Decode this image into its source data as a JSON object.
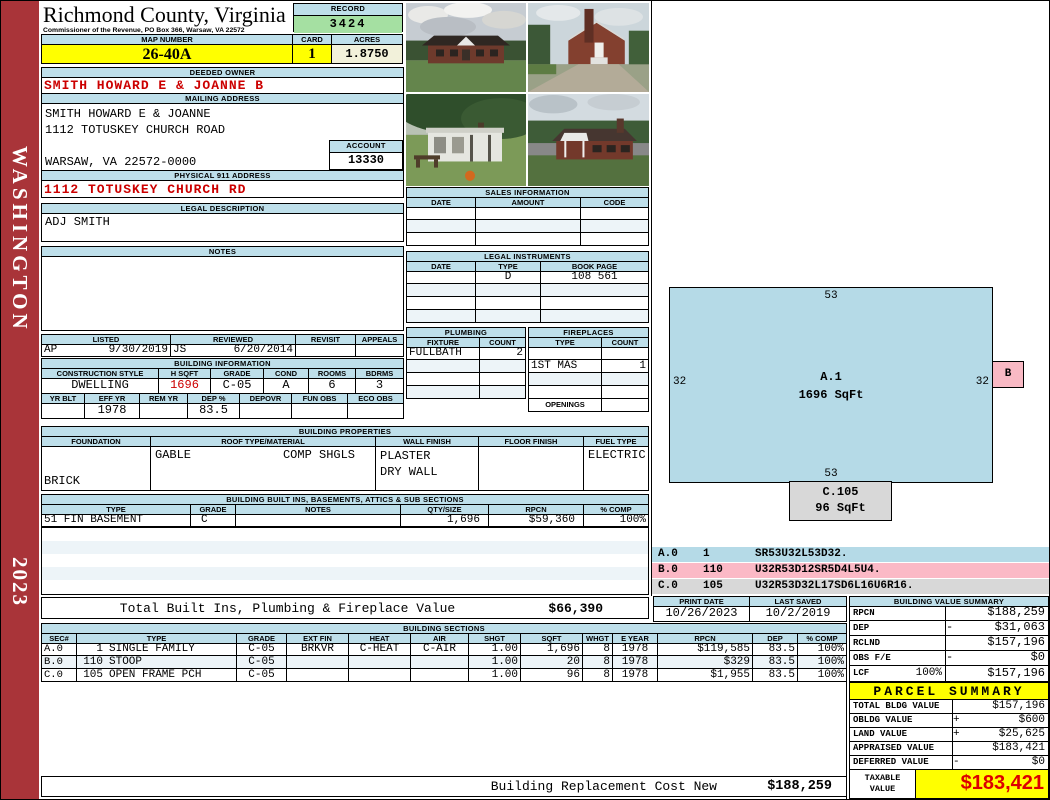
{
  "colors": {
    "bar_blue": "#BEDFEA",
    "yellow": "#FFFF00",
    "record_green": "#A5E0A2",
    "acres_cream": "#F2F1DA",
    "red_text": "#CC0000",
    "sidebar_red": "#A93439",
    "sketch_blue": "#B5DAE7",
    "sketch_pink": "#F9B9C4",
    "sketch_gray": "#D8D8D8"
  },
  "sidebar": {
    "state": "WASHINGTON",
    "year": "2023"
  },
  "header": {
    "county": "Richmond County, Virginia",
    "commissioner_line": "Commissioner of the Revenue, PO Box 366, Warsaw, VA 22572",
    "record_label": "RECORD",
    "record_number": "3424",
    "map_number_label": "MAP NUMBER",
    "map_number": "26-40A",
    "card_label": "CARD",
    "card": "1",
    "acres_label": "ACRES",
    "acres": "1.8750"
  },
  "owner": {
    "deeded_owner_label": "DEEDED OWNER",
    "deeded_owner": "SMITH HOWARD E & JOANNE B",
    "mailing_address_label": "MAILING ADDRESS",
    "mailing_line1": "SMITH HOWARD E & JOANNE",
    "mailing_line2": "1112 TOTUSKEY CHURCH ROAD",
    "mailing_line3": "WARSAW, VA 22572-0000",
    "account_label": "ACCOUNT",
    "account": "13330",
    "physical_address_label": "PHYSICAL 911 ADDRESS",
    "physical_address": "1112 TOTUSKEY CHURCH RD"
  },
  "legal": {
    "label": "LEGAL DESCRIPTION",
    "value": "ADJ SMITH"
  },
  "notes": {
    "label": "NOTES",
    "value": ""
  },
  "review": {
    "listed_label": "LISTED",
    "reviewed_label": "REVIEWED",
    "revisit_label": "REVISIT",
    "appeals_label": "APPEALS",
    "listed_by": "AP",
    "listed_date": "9/30/2019",
    "reviewed_by": "JS",
    "reviewed_date": "6/20/2014",
    "revisit": "",
    "appeals": ""
  },
  "building_info": {
    "title": "BUILDING INFORMATION",
    "row1_headers": [
      "CONSTRUCTION STYLE",
      "H SQFT",
      "GRADE",
      "COND",
      "ROOMS",
      "BDRMS"
    ],
    "row1_values": [
      "DWELLING",
      "1696",
      "C-05",
      "A",
      "6",
      "3"
    ],
    "row2_headers": [
      "YR BLT",
      "EFF YR",
      "REM YR",
      "DEP %",
      "DEPOVR",
      "FUN OBS",
      "ECO OBS"
    ],
    "row2_values": [
      "",
      "1978",
      "",
      "83.5",
      "",
      "",
      ""
    ]
  },
  "photos": {
    "names": [
      "house-front-photo",
      "house-side-photo",
      "house-porch-photo",
      "house-rear-photo"
    ]
  },
  "sales": {
    "title": "SALES INFORMATION",
    "headers": [
      "DATE",
      "AMOUNT",
      "CODE"
    ]
  },
  "instruments": {
    "title": "LEGAL INSTRUMENTS",
    "headers": [
      "DATE",
      "TYPE",
      "BOOK PAGE"
    ],
    "row1": {
      "date": "",
      "type": "D",
      "book_page": "108 561"
    }
  },
  "plumbing": {
    "title": "PLUMBING",
    "headers": [
      "FIXTURE",
      "COUNT"
    ],
    "row1": {
      "fixture": "FULLBATH",
      "count": "2"
    }
  },
  "fireplaces": {
    "title": "FIREPLACES",
    "headers": [
      "TYPE",
      "COUNT"
    ],
    "row2": {
      "type": "1ST MAS",
      "count": "1"
    },
    "openings_label": "OPENINGS",
    "openings": ""
  },
  "properties": {
    "title": "BUILDING PROPERTIES",
    "headers": [
      "FOUNDATION",
      "ROOF TYPE/MATERIAL",
      "WALL FINISH",
      "FLOOR FINISH",
      "FUEL TYPE"
    ],
    "foundation": "BRICK",
    "roof_type": "GABLE",
    "roof_material": "COMP SHGLS",
    "wall_finish_1": "PLASTER",
    "wall_finish_2": "DRY WALL",
    "floor_finish": "",
    "fuel_type": "ELECTRIC"
  },
  "builtins": {
    "title": "BUILDING BUILT INS, BASEMENTS, ATTICS & SUB SECTIONS",
    "headers": [
      "TYPE",
      "GRADE",
      "NOTES",
      "QTY/SIZE",
      "RPCN",
      "% COMP"
    ],
    "rows": [
      [
        "51 FIN BASEMENT",
        "C",
        "",
        "1,696",
        "$59,360",
        "100%"
      ]
    ],
    "total_label": "Total Built Ins, Plumbing & Fireplace Value",
    "total_value": "$66,390"
  },
  "printsave": {
    "print_date_label": "PRINT DATE",
    "print_date": "10/26/2023",
    "last_saved_label": "LAST SAVED",
    "last_saved": "10/2/2019"
  },
  "sections": {
    "title": "BUILDING SECTIONS",
    "headers": [
      "SEC#",
      "TYPE",
      "GRADE",
      "EXT FIN",
      "HEAT",
      "AIR",
      "SHGT",
      "SQFT",
      "WHGT",
      "E YEAR",
      "RPCN",
      "DEP",
      "% COMP"
    ],
    "rows": [
      [
        "A.0",
        "1",
        "SINGLE FAMILY",
        "C-05",
        "BRKVR",
        "C-HEAT",
        "C-AIR",
        "1.00",
        "1,696",
        "8",
        "1978",
        "$119,585",
        "83.5",
        "100%"
      ],
      [
        "B.0",
        "110",
        "STOOP",
        "C-05",
        "",
        "",
        "",
        "1.00",
        "20",
        "8",
        "1978",
        "$329",
        "83.5",
        "100%"
      ],
      [
        "C.0",
        "105",
        "OPEN FRAME PCH",
        "C-05",
        "",
        "",
        "",
        "1.00",
        "96",
        "8",
        "1978",
        "$1,955",
        "83.5",
        "100%"
      ]
    ]
  },
  "value_summary": {
    "title": "BUILDING VALUE SUMMARY",
    "rows": [
      [
        "RPCN",
        "",
        "",
        "$188,259"
      ],
      [
        "DEP",
        "",
        "-",
        "$31,063"
      ],
      [
        "RCLND",
        "",
        "",
        "$157,196"
      ],
      [
        "OBS F/E",
        "",
        "-",
        "$0"
      ],
      [
        "LCF",
        "100%",
        "",
        "$157,196"
      ]
    ]
  },
  "parcel": {
    "title": "PARCEL SUMMARY",
    "rows": [
      [
        "TOTAL BLDG VALUE",
        "",
        "$157,196"
      ],
      [
        "OBLDG VALUE",
        "+",
        "$600"
      ],
      [
        "LAND VALUE",
        "+",
        "$25,625"
      ],
      [
        "APPRAISED VALUE",
        "",
        "$183,421"
      ],
      [
        "DEFERRED VALUE",
        "-",
        "$0"
      ]
    ],
    "taxable_label_1": "TAXABLE",
    "taxable_label_2": "VALUE",
    "taxable_value": "$183,421"
  },
  "sketch": {
    "main": {
      "label": "A.1",
      "sqft": "1696 SqFt",
      "dim_top": "53",
      "dim_bottom": "53",
      "dim_left": "32",
      "dim_right": "32"
    },
    "b_label": "B",
    "c": {
      "label": "C.105",
      "sqft": "96 SqFt"
    },
    "legend": [
      [
        "A.0",
        "1",
        "SR53U32L53D32."
      ],
      [
        "B.0",
        "110",
        "U32R53D12SR5D4L5U4."
      ],
      [
        "C.0",
        "105",
        "U32R53D32L17SD6L16U6R16."
      ]
    ]
  },
  "bottom": {
    "label": "Building Replacement Cost New",
    "value": "$188,259"
  }
}
